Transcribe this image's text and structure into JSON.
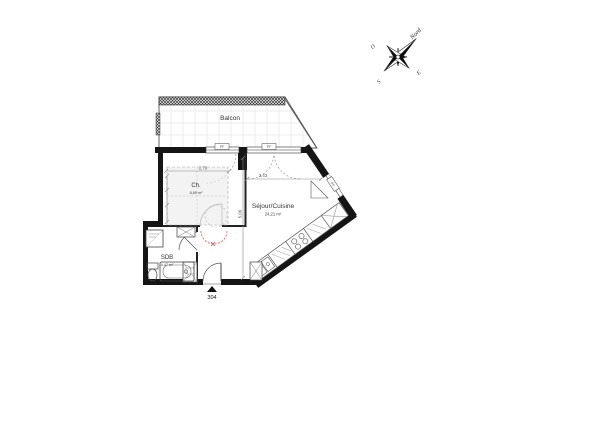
{
  "plan": {
    "unit_number": "304",
    "rooms": [
      {
        "id": "balcon",
        "name": "Balcon",
        "area": ""
      },
      {
        "id": "chambre",
        "name": "Ch.",
        "area": "8,69 m²"
      },
      {
        "id": "sejour",
        "name": "Séjour/Cuisine",
        "area": "24,21 m²"
      },
      {
        "id": "sdb",
        "name": "SDB",
        "area": "4,47 m²"
      }
    ],
    "dimensions": [
      {
        "id": "dim-chambre-width",
        "value": "2,79"
      },
      {
        "id": "dim-sejour-width",
        "value": "3,43"
      },
      {
        "id": "dim-sejour-height",
        "value": "5,06"
      }
    ],
    "window_tags": [
      "PF",
      "PF",
      "PF"
    ],
    "colors": {
      "wall": "#151515",
      "outline": "#555555",
      "tile_grid": "#dddddd",
      "dashed_furniture": "#9a9a9a",
      "red_swing": "#d46a6a"
    }
  },
  "compass": {
    "north_label": "Nord",
    "west_label": "O",
    "south_label": "S",
    "east_label": "E"
  }
}
